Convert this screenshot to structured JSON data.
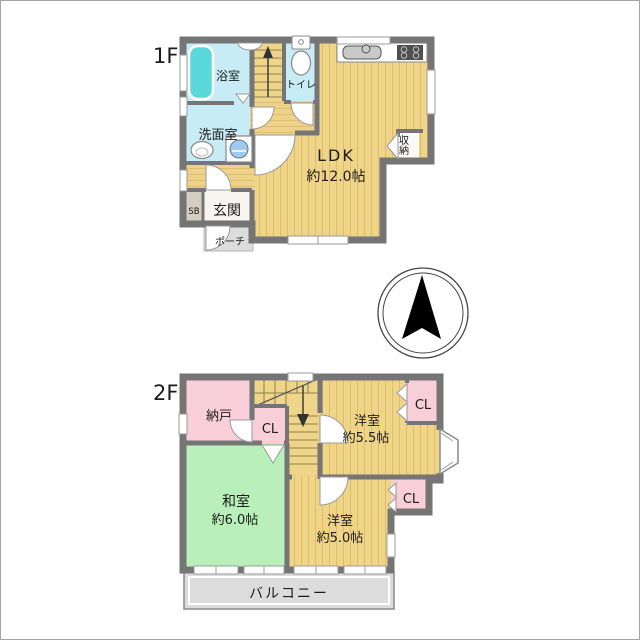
{
  "floor1": {
    "label": "1F",
    "bath": "浴室",
    "toilet": "トイレ",
    "washroom": "洗面室",
    "ldk_name": "LDK",
    "ldk_size": "約12.0帖",
    "storage": "収納",
    "shoe_box": "SB",
    "entrance": "玄関",
    "porch": "ポーチ"
  },
  "floor2": {
    "label": "2F",
    "storeroom": "納戸",
    "closet_hall": "CL",
    "closet_west1": "CL",
    "closet_west2": "CL",
    "west_room1_name": "洋室",
    "west_room1_size": "約5.5帖",
    "japanese_room_name": "和室",
    "japanese_room_size": "約6.0帖",
    "west_room2_name": "洋室",
    "west_room2_size": "約5.0帖",
    "balcony": "バルコニー"
  },
  "compass": {
    "direction": "up"
  },
  "colors": {
    "wall": "#757575",
    "wood_floor": "#f0d488",
    "floor_stripe": "#dcbd6b",
    "water_room_cyan": "#c8ecf5",
    "bathtub_teal": "#5ad8da",
    "tatami_green": "#b9efb9",
    "closet_pink": "#f8cfd8",
    "balcony_gray": "#dcdcdc",
    "shoe_box_beige": "#d5cdc0",
    "text": "#1b1b1b"
  }
}
